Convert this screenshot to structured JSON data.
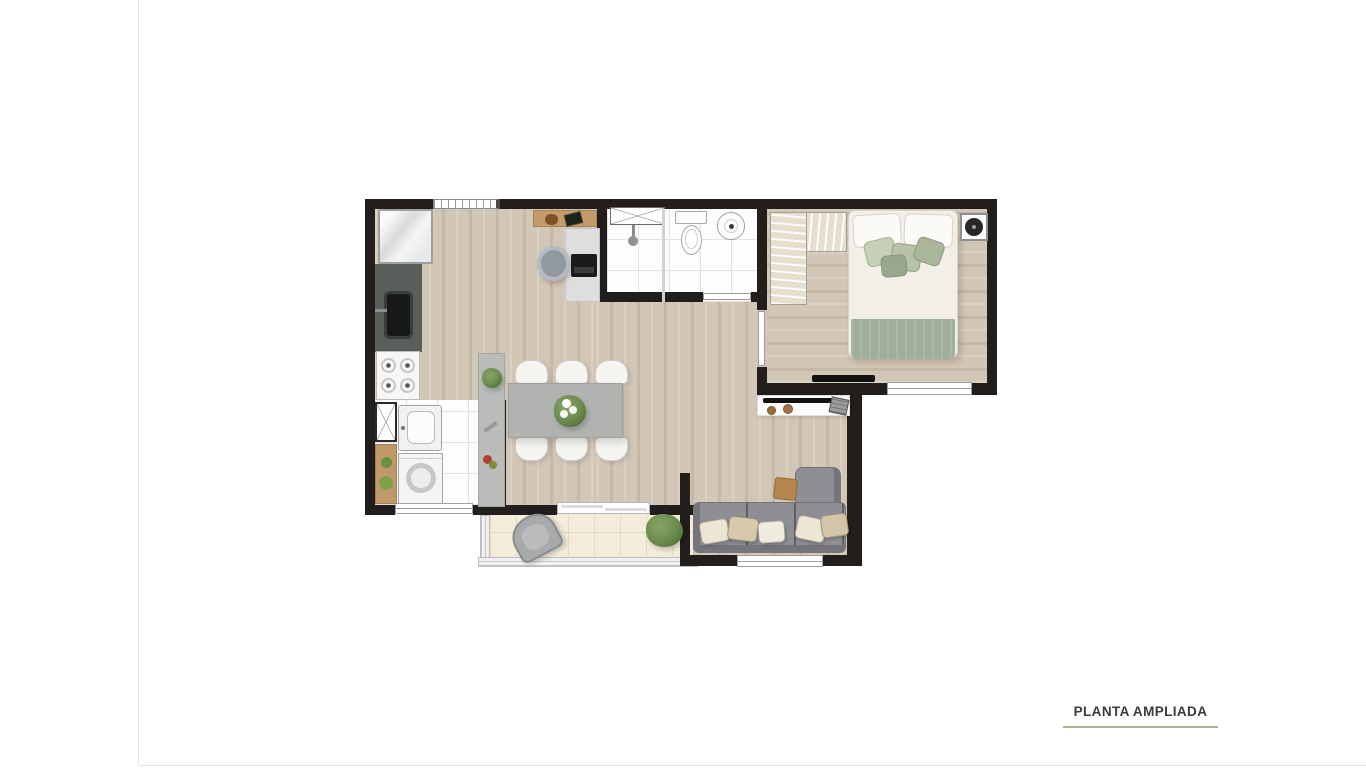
{
  "page": {
    "background": "#ffffff"
  },
  "dividers": {
    "color": "#e3e3e3"
  },
  "footer": {
    "label": "PLANTA AMPLIADA",
    "text_color": "#3b3b3b",
    "underline_color": "#b3b096"
  },
  "colors": {
    "wall": "#211e1c",
    "wood_a": "#d2c6b6",
    "wood_b": "#c4b8a7",
    "wood_c": "#dbd1c3",
    "tile": "#fdfdfd",
    "grout": "#e2e2e2",
    "balcony_tile": "#f3ecda",
    "balcony_grout": "#e4dac1",
    "counter": "#5a5e5a",
    "sink": "#161916",
    "table": "#b1b3b0",
    "chair": "#f6f5f1",
    "sofa": "#8e8f95",
    "sofa_dark": "#75767c",
    "bed_duvet": "#f1efe7",
    "bed_blanket": "#9fae9a",
    "pillow_sage": "#b7c2a8",
    "closet": "#e6dfd0",
    "wood_furniture": "#c0996a",
    "plant": "#6a8a4e",
    "rack": "#fcfcfc",
    "tv": "#121212",
    "divider": "#e3e3e3",
    "accent_underline": "#b3b096",
    "label_text": "#3b3b3b"
  },
  "floorplan": {
    "type": "apartment-top-view",
    "rooms": [
      "kitchen",
      "laundry",
      "dining",
      "bathroom",
      "hall",
      "bedroom",
      "living",
      "balcony"
    ],
    "furniture": [
      "fridge",
      "kitchen-counter",
      "kitchen-sink",
      "stove",
      "service-shaft",
      "laundry-tank",
      "washing-machine",
      "laundry-shelf",
      "kitchen-peninsula",
      "peninsula-plant",
      "dining-table",
      "dining-chairs",
      "flower-centerpiece",
      "entry-sideboard",
      "desk",
      "office-chair",
      "laptop",
      "shower-niche",
      "shower-head",
      "shower-partition",
      "toilet",
      "washbasin",
      "wardrobe",
      "double-bed",
      "bed-pillows",
      "bed-blanket",
      "speaker-panel",
      "bedroom-tv",
      "tv-rack",
      "living-tv",
      "media-console",
      "sofa",
      "sofa-cushions",
      "side-table",
      "lounge-chair",
      "balcony-plant"
    ],
    "openings": [
      "kitchen-window",
      "laundry-window",
      "balcony-sliding-door",
      "bedroom-window",
      "living-window",
      "bathroom-door",
      "bedroom-door"
    ]
  }
}
